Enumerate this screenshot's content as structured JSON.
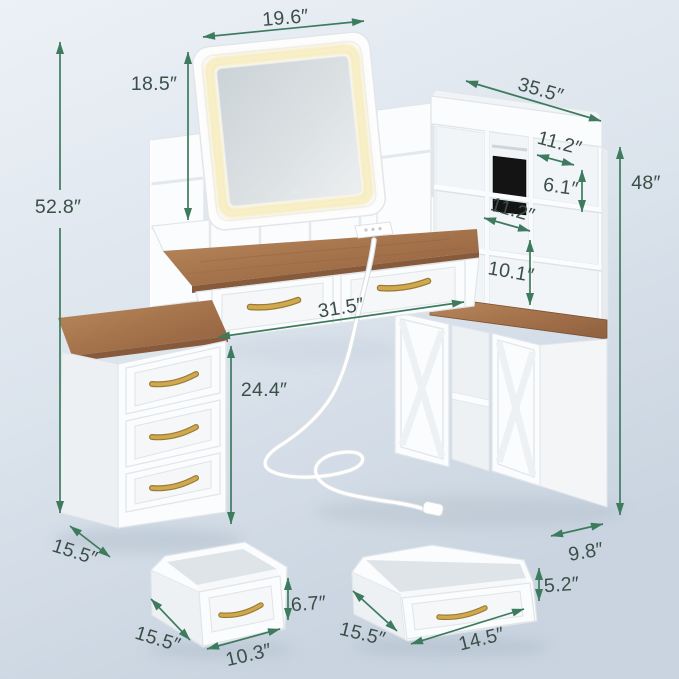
{
  "meta": {
    "title": "Vanity desk dimension diagram",
    "units": "inches"
  },
  "colors": {
    "arrow": "#3e7b5e",
    "label_text": "#3b4f49",
    "wood": "#a9764e",
    "led_glow": "#f6e9b5",
    "handle_gold": "#c9a24b",
    "tablet": "#141414",
    "background_top": "#ebf0f5",
    "background_bottom": "#ccd7e2"
  },
  "labels": {
    "mirror_width": "19.6″",
    "mirror_height": "18.5″",
    "overall_height": "52.8″",
    "hutch_width": "35.5″",
    "top_cubby_width": "11.2″",
    "top_cubby_height": "6.1″",
    "hutch_height": "48″",
    "mid_shelf_width": "11.2″",
    "shelf_to_desktop": "10.1″",
    "desk_width": "31.5″",
    "knee_clearance": "24.4″",
    "left_cabinet_depth": "15.5″",
    "right_cabinet_depth": "9.8″",
    "small_drawer_depth": "15.5″",
    "small_drawer_width": "10.3″",
    "small_drawer_height": "6.7″",
    "large_drawer_depth": "15.5″",
    "large_drawer_width": "14.5″",
    "large_drawer_height": "5.2″"
  }
}
